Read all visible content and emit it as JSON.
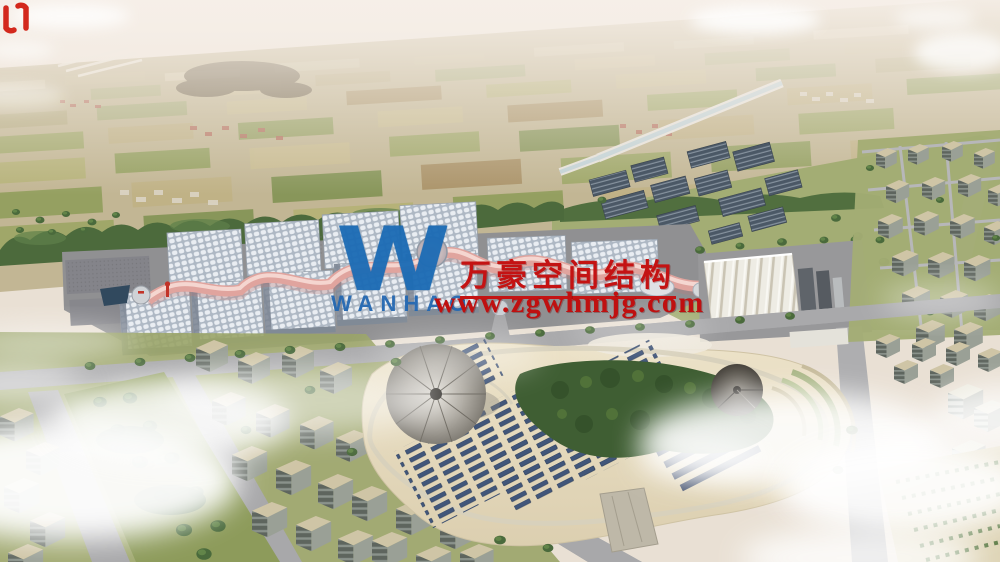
{
  "scene": {
    "kind": "aerial architectural rendering",
    "description": "Bird's-eye render of an exhibition center campus: gridded-roof halls joined by a pink wavy membrane spine, a white ridged hall, rooftop/ground solar arrays, a sand-colored central park with cone pavilions and solar rows, residential blocks, farmland horizon with a diagonal canal, scattered clouds.",
    "palette": {
      "haze_sky": "#f2ebe4",
      "farmland_tan": "#c2b694",
      "field_green": "#9aa562",
      "tree_green": "#4a6a3c",
      "asphalt": "#a9a9ab",
      "hall_roof": "#e9edf2",
      "membrane_pink": "#e0a49e",
      "solar_slate": "#4b5866",
      "park_sand": "#e6dcc0",
      "panel_blue": "#41567a"
    }
  },
  "watermark": {
    "logo_letter": "W",
    "logo_wordmark": "WANHAO",
    "brand_name": "万豪空间结构",
    "website": "www.zgwhmjg.com",
    "red": "#c41313",
    "blue": "#1d6cb5"
  }
}
